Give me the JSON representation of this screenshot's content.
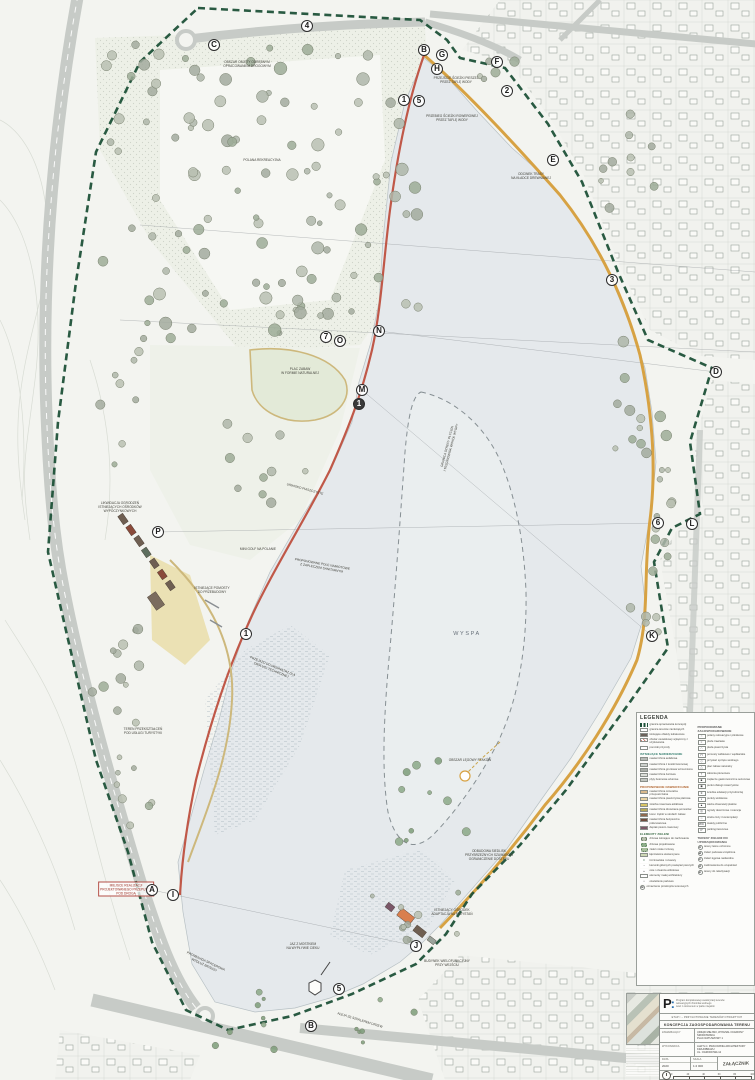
{
  "map": {
    "island_label": "WYSPA",
    "markers": [
      {
        "label": "4",
        "x": 307,
        "y": 26
      },
      {
        "label": "C",
        "x": 214,
        "y": 45
      },
      {
        "label": "B",
        "x": 424,
        "y": 50
      },
      {
        "label": "G",
        "x": 442,
        "y": 55
      },
      {
        "label": "F",
        "x": 497,
        "y": 62
      },
      {
        "label": "H",
        "x": 437,
        "y": 69
      },
      {
        "label": "2",
        "x": 507,
        "y": 91
      },
      {
        "label": "1",
        "x": 404,
        "y": 100
      },
      {
        "label": "5",
        "x": 419,
        "y": 101
      },
      {
        "label": "E",
        "x": 553,
        "y": 160
      },
      {
        "label": "3",
        "x": 612,
        "y": 280
      },
      {
        "label": "N",
        "x": 379,
        "y": 331
      },
      {
        "label": "7",
        "x": 326,
        "y": 337
      },
      {
        "label": "O",
        "x": 340,
        "y": 341
      },
      {
        "label": "D",
        "x": 716,
        "y": 372
      },
      {
        "label": "M",
        "x": 362,
        "y": 390
      },
      {
        "label": "1",
        "x": 359,
        "y": 404,
        "filled": true
      },
      {
        "label": "P",
        "x": 158,
        "y": 532
      },
      {
        "label": "6",
        "x": 658,
        "y": 523
      },
      {
        "label": "L",
        "x": 692,
        "y": 524
      },
      {
        "label": "1",
        "x": 246,
        "y": 634
      },
      {
        "label": "K",
        "x": 652,
        "y": 636
      },
      {
        "label": "A",
        "x": 152,
        "y": 890
      },
      {
        "label": "I",
        "x": 173,
        "y": 895
      },
      {
        "label": "J",
        "x": 416,
        "y": 946
      },
      {
        "label": "5",
        "x": 339,
        "y": 989
      },
      {
        "label": "B",
        "x": 311,
        "y": 1026
      }
    ],
    "annotations": [
      {
        "t": "OBSZAR OBJĘTY ODRĘBNYM\nOPRACOWANIEM DROGOWYM",
        "x": 247,
        "y": 64
      },
      {
        "t": "POLANA REKREACYJNA",
        "x": 262,
        "y": 160
      },
      {
        "t": "PRZEJŚCIE ŚCIEŻKI PIESZEJ\nPRZEZ TAFLĘ WODY",
        "x": 456,
        "y": 80
      },
      {
        "t": "PRZEBIEG ŚCIEŻKI ROWEROWEJ\nPRZEZ TAFLĘ WODY",
        "x": 452,
        "y": 118
      },
      {
        "t": "ODCINEK TRASY\nNA KŁADCE DREWNIANEJ",
        "x": 531,
        "y": 176
      },
      {
        "t": "PLAC ZABAW\nW FORMIE NATURALNEJ",
        "x": 300,
        "y": 371
      },
      {
        "t": "GRANICA STREFY PŁYCIZN\nI TRZCINOWISK WOKÓŁ WYSPY",
        "x": 449,
        "y": 447,
        "r": -75
      },
      {
        "t": "URWISKO PIASZCZYSTE",
        "x": 305,
        "y": 489,
        "r": 15
      },
      {
        "t": "LIKWIDACJA OGRODZEŃ\nISTNIEJĄCYCH OŚRODKÓW\nWYPOCZYNKOWYCH",
        "x": 120,
        "y": 507
      },
      {
        "t": "MINI GOLF NA POLANIE",
        "x": 258,
        "y": 549
      },
      {
        "t": "PROPONOWANE POLE NAMIOTOWE\nZ ZAPLECZEM SANITARNYM",
        "x": 322,
        "y": 566,
        "r": 10
      },
      {
        "t": "ISTNIEJĄCE POMOSTY\nDO PRZEBUDOWY",
        "x": 212,
        "y": 590
      },
      {
        "t": "PRZEJAZD DO WEWNĄTRZ DLA\nOBSŁUGI TECHNICZNEJ",
        "x": 272,
        "y": 668,
        "r": 22
      },
      {
        "t": "TEREN PRZEKSZTAŁCEŃ\nPOD USŁUGI TURYSTYKI",
        "x": 143,
        "y": 731
      },
      {
        "t": "OBSZAR LĘGOWY PTAKÓW",
        "x": 470,
        "y": 760
      },
      {
        "t": "ODBUDOWA SIEDLISK\nPRZYBRZEŻNYCH SZUWARÓW\nOGRANICZENIE DOSTĘPU",
        "x": 489,
        "y": 855
      },
      {
        "t": "MIEJSCE REALIZACJI\nPROJEKTOWANEGO PRZEPUSTU\nPOD DROGĄ",
        "x": 126,
        "y": 889,
        "red": true
      },
      {
        "t": "ISTNIEJĄCY OŚRODEK\nADAPTACJA NA PRZYSTAŃ",
        "x": 452,
        "y": 912
      },
      {
        "t": "JAZ Z MOSTKIEM\nNA WYPŁYWIE CIEKU",
        "x": 303,
        "y": 946
      },
      {
        "t": "BUDYNEK WIELOFUNKCYJNY\nPRZY WEJŚCIU",
        "x": 447,
        "y": 963
      },
      {
        "t": "PROMENADA SPACEROWA\nWZDŁUŻ BRZEGU",
        "x": 205,
        "y": 963,
        "r": 25
      },
      {
        "t": "ALEJA ZE SZPALEREM DRZEW",
        "x": 360,
        "y": 1020,
        "r": 17
      }
    ]
  },
  "legend": {
    "title": "LEGENDA",
    "columns": [
      {
        "sections": [
          {
            "heading": null,
            "color": null,
            "items": [
              {
                "t": "granica opracowania koncepcji",
                "sw": "dash"
              },
              {
                "t": "granica terenów zamkniętych",
                "sw": "out"
              },
              {
                "t": "istniejące obiekty kubaturowe",
                "sw": "bld"
              },
              {
                "t": "obszar osuwiskowy wyłączony z użytkowania",
                "sw": "hatch"
              },
              {
                "t": "pomniki przyrody",
                "sw": "star"
              }
            ]
          },
          {
            "heading": "ISTNIEJĄCE NAWIERZCHNIE",
            "color": "#2e7a6a",
            "items": [
              {
                "t": "nawierzchnia asfaltowa",
                "sw": "#b6bab6"
              },
              {
                "t": "nawierzchnia z kostki betonowej",
                "sw": "#cdd1cd"
              },
              {
                "t": "nawierzchnia gruntowa wzmocniona",
                "sw": "#a9ada7"
              },
              {
                "t": "nawierzchnia żwirowa",
                "sw": "#dcdfd9"
              },
              {
                "t": "płyty betonowe ażurowe",
                "sw": "#c2c6c0"
              }
            ]
          },
          {
            "heading": "PROPONOWANE NAWIERZCHNIE",
            "color": "#b0642f",
            "items": [
              {
                "t": "nawierzchnia mineralna przepuszczalna",
                "sw": "#d9b98c"
              },
              {
                "t": "nawierzchnia piaszczysta plażowa",
                "sw": "#e8d3a4"
              },
              {
                "t": "ścieżka rowerowa asfaltowa",
                "sw": "#d8c565"
              },
              {
                "t": "nawierzchnia drewniana pomostów",
                "sw": "#b5a95a"
              },
              {
                "t": "kora i zrębki w strefach zabaw",
                "sw": "#8f6a4e"
              },
              {
                "t": "nawierzchnia bezpieczna poliuretanowa",
                "sw": "#6f4d3d"
              },
              {
                "t": "deptak pieszo-rowerowy",
                "sw": "#7c5a68"
              }
            ]
          },
          {
            "heading": "ELEMENTY ZIELENI",
            "color": "#3a6b46",
            "items": [
              {
                "t": "drzewa istniejące do zachowania",
                "sw": "tree"
              },
              {
                "t": "drzewa projektowane",
                "sw": "treeg"
              },
              {
                "t": "zieleń niska i krzewy",
                "sw": "shrub"
              },
              {
                "t": "łąki kwietne ekstensywne",
                "sw": "#cdd8b4"
              },
              {
                "t": "trzcinowiska i szuwary",
                "sw": "reed"
              }
            ]
          },
          {
            "heading": null,
            "color": null,
            "items": [
              {
                "t": "kierunki głównych powiązań pieszych",
                "sw": "arrow"
              },
              {
                "t": "osie i otwarcia widokowe",
                "sw": "eye"
              },
              {
                "t": "elementy małej architektury",
                "sw": "out"
              },
              {
                "t": "oświetlenie parkowe",
                "sw": "dot"
              },
              {
                "t": "oznaczenie przekrojów terenowych",
                "sw": "circ",
                "ch": "B"
              }
            ]
          }
        ]
      },
      {
        "sections": [
          {
            "heading": "PROPONOWANE ZAGOSPODAROWANIE",
            "color": "#555555",
            "items": [
              {
                "t": "polany rekreacyjne i piknikowe",
                "sw": "ic",
                "g": "○"
              },
              {
                "t": "plaże trawiaste",
                "sw": "ic",
                "g": "≈"
              },
              {
                "t": "plaża piaszczysta",
                "sw": "ic",
                "g": "∴"
              },
              {
                "t": "pomosty widokowe i wędkarskie",
                "sw": "ic",
                "g": "⊓"
              },
              {
                "t": "przystań sprzętu wodnego",
                "sw": "ic",
                "g": "◇"
              },
              {
                "t": "plac zabaw naturalny",
                "sw": "ic",
                "g": "△"
              },
              {
                "t": "siłownia plenerowa",
                "sw": "ic",
                "g": "†"
              },
              {
                "t": "zaplecze gastronomiczne sezonowe",
                "sw": "ic",
                "g": "■"
              },
              {
                "t": "punkt obsługi rowerzystów",
                "sw": "ic",
                "g": "◉"
              },
              {
                "t": "ścieżka edukacji przyrodniczej",
                "sw": "ic",
                "g": "∗"
              },
              {
                "t": "punkty widokowe",
                "sw": "ic",
                "g": "◐"
              },
              {
                "t": "wieża obserwacji ptaków",
                "sw": "ic",
                "g": "▲"
              },
              {
                "t": "ogrody deszczowe i retencja",
                "sw": "ic",
                "g": "◎"
              },
              {
                "t": "strefa ciszy i kontemplacji",
                "sw": "ic",
                "g": "☼"
              },
              {
                "t": "toalety publiczne",
                "sw": "ic",
                "g": "WC"
              },
              {
                "t": "parkingi terenowe",
                "sw": "ic",
                "g": "P"
              }
            ]
          },
          {
            "heading": "TERENY ZIELENI DO UPORZĄDKOWANIA",
            "color": "#555555",
            "items": [
              {
                "t": "tereny leśne ochronne",
                "sw": "circ",
                "ch": "A"
              },
              {
                "t": "zieleń parkowa urządzona",
                "sw": "circ",
                "ch": "B"
              },
              {
                "t": "zieleń łęgowa nadwodna",
                "sw": "circ",
                "ch": "C"
              },
              {
                "t": "zadrzewienia do uzupełnień",
                "sw": "circ",
                "ch": "D"
              },
              {
                "t": "tereny do rekultywacji",
                "sw": "circ",
                "ch": "E"
              }
            ]
          }
        ]
      }
    ]
  },
  "titleblock": {
    "logo": "P",
    "logo_colon": ":",
    "program_lines": [
      "Program kompleksowej rewaloryzacji terenów",
      "rekreacyjnych zbiornika wodnego",
      "wraz z otoczeniem w parku miejskim"
    ],
    "stage": "ETAP I – PRZYGOTOWANIE TERENÓW OTWARTYCH",
    "doc_title": "KONCEPCJA ZAGOSPODAROWANIA TERENU",
    "rows": [
      {
        "label": "ZAMAWIAJĄCY",
        "value": "URZĄD MIEJSKI, WYDZIAŁ OCHRONY ŚRODOWISKA\nPLAC RATUSZOWY 1"
      },
      {
        "label": "WYKONAWCA",
        "value": "ALW S.C. PRACOWNIA ARCHITEKTURY KRAJOBRAZU\nUL. OGRODOWA 12"
      }
    ],
    "date_label": "DATA",
    "date": "2020",
    "scale_label": "SKALA",
    "scale": "1:2 000",
    "attachment": "ZAŁĄCZNIK",
    "scalebar": [
      "0",
      "20",
      "40",
      "60",
      "80",
      "100 m"
    ]
  }
}
